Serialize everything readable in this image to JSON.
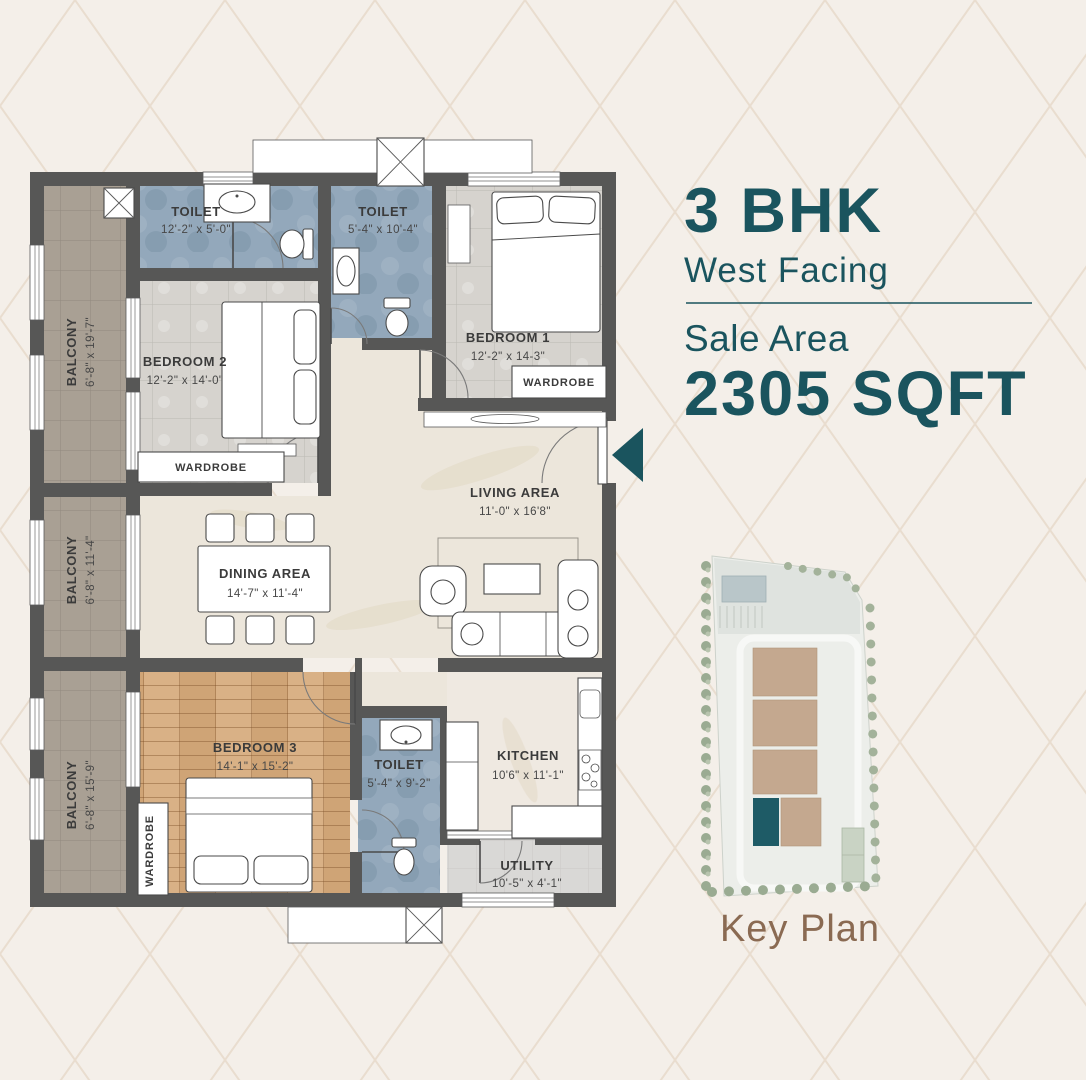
{
  "header": {
    "bhk": "3 BHK",
    "facing": "West Facing",
    "sale_area_label": "Sale Area",
    "sale_area_value": "2305 SQFT"
  },
  "key_plan": {
    "caption": "Key Plan"
  },
  "floor_plan": {
    "toilet_1": {
      "label": "TOILET",
      "dims": "12'-2\" x 5'-0\""
    },
    "toilet_2": {
      "label": "TOILET",
      "dims": "5'-4\" x 10'-4\""
    },
    "toilet_3": {
      "label": "TOILET",
      "dims": "5'-4\" x 9'-2\""
    },
    "bedroom_1": {
      "label": "BEDROOM 1",
      "dims": "12'-2\" x 14-3\""
    },
    "bedroom_2": {
      "label": "BEDROOM 2",
      "dims": "12'-2\" x 14'-0\""
    },
    "bedroom_3": {
      "label": "BEDROOM 3",
      "dims": "14'-1\" x 15'-2\""
    },
    "living_area": {
      "label": "LIVING AREA",
      "dims": "11'-0\" x 16'8\""
    },
    "dining_area": {
      "label": "DINING AREA",
      "dims": "14'-7\" x 11'-4\""
    },
    "kitchen": {
      "label": "KITCHEN",
      "dims": "10'6\" x 11'-1\""
    },
    "utility": {
      "label": "UTILITY",
      "dims": "10'-5\" x 4'-1\""
    },
    "balcony_1": {
      "label": "BALCONY",
      "dims": "6'-8\" x 19'-7\""
    },
    "balcony_2": {
      "label": "BALCONY",
      "dims": "6'-8\" x 11'-4\""
    },
    "balcony_3": {
      "label": "BALCONY",
      "dims": "6'-8\" x 15'-9\""
    },
    "wardrobe_bedroom_1": {
      "label": "WARDROBE"
    },
    "wardrobe_bedroom_2": {
      "label": "WARDROBE"
    },
    "wardrobe_bedroom_3": {
      "label": "WARDROBE"
    }
  },
  "colors": {
    "accent_teal": "#1A545E",
    "wall": "#575756",
    "toilet_floor": "#93A8BB",
    "balcony_floor": "#A9A094",
    "bedroom_tile": "#D6D3CE",
    "wood_floor": "#D5AC7E",
    "living_floor": "#ECE6DB",
    "utility_floor": "#D9D8D6",
    "keyplan_building": "#C4A88F",
    "keyplan_highlight": "#1E5B66",
    "keyplan_caption": "#8A6A52",
    "background": "#F4EFE9"
  }
}
